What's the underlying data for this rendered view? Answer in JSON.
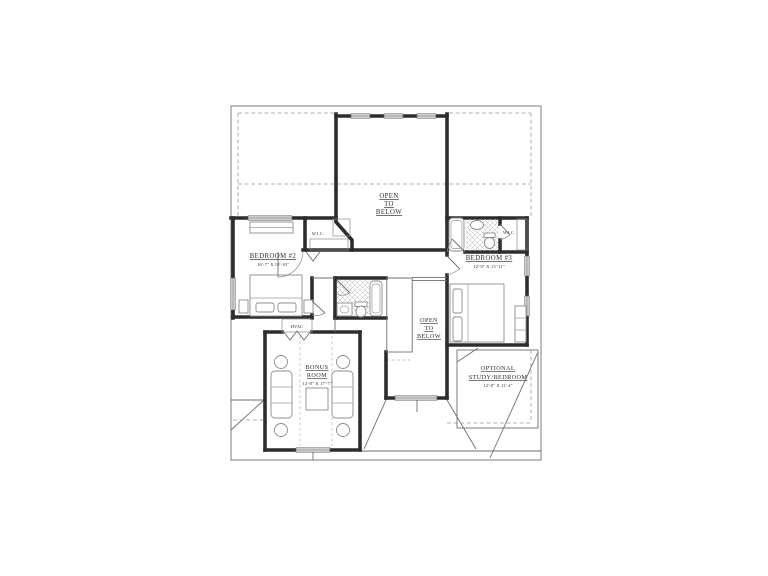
{
  "plan": {
    "type": "floor-plan",
    "labels": {
      "open_to_below_upper": {
        "line1": "OPEN",
        "line2": "TO",
        "line3": "BELOW"
      },
      "open_to_below_lower": {
        "line1": "OPEN",
        "line2": "TO",
        "line3": "BELOW"
      },
      "bedroom2": {
        "name": "BEDROOM #2",
        "dims": "16'-7\" X 15'-10\""
      },
      "bedroom3": {
        "name": "BEDROOM #3",
        "dims": "12'-0\" X 13'-11\""
      },
      "bonus_room": {
        "name_line1": "BONUS",
        "name_line2": "ROOM",
        "dims": "12'-0\" X 17'-7\""
      },
      "optional_study": {
        "name_line1": "OPTIONAL",
        "name_line2": "STUDY/BEDROOM",
        "dims": "12'-0\" X 11'-4\""
      },
      "wic_left": "W.I.C.",
      "wic_right": "W.I.C.",
      "hvac": "HVAC"
    },
    "colors": {
      "paper": "#ffffff",
      "wall": "#2d2d2d",
      "thin_line": "#6e6e6e",
      "dashed_line": "#9b9b9b",
      "window_fill": "#d8d8d8",
      "text": "#2e2e2e"
    }
  }
}
